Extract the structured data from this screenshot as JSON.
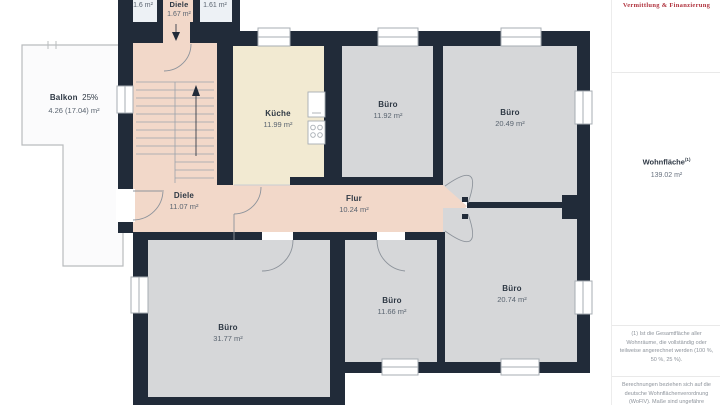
{
  "plan": {
    "rooms": {
      "balkon": {
        "name": "Balkon",
        "share": "25%",
        "area": "4.26 (17.04) m²"
      },
      "raum_ol": {
        "area": "1.6 m²"
      },
      "diele_top": {
        "name": "Diele",
        "area": "1.67 m²"
      },
      "raum_or": {
        "area": "1.61 m²"
      },
      "kueche": {
        "name": "Küche",
        "area": "11.99 m²"
      },
      "buero_nw": {
        "name": "Büro",
        "area": "11.92 m²"
      },
      "buero_ne": {
        "name": "Büro",
        "area": "20.49 m²"
      },
      "diele": {
        "name": "Diele",
        "area": "11.07 m²"
      },
      "flur": {
        "name": "Flur",
        "area": "10.24 m²"
      },
      "buero_sw": {
        "name": "Büro",
        "area": "31.77 m²"
      },
      "buero_sm": {
        "name": "Büro",
        "area": "11.66 m²"
      },
      "buero_se": {
        "name": "Büro",
        "area": "20.74 m²"
      }
    },
    "colors": {
      "wall": "#212b39",
      "office_fill": "#d6d7d9",
      "corridor_fill": "#f2d8c9",
      "kitchen_fill": "#f2ead2",
      "side_room_fill": "#edf1f5",
      "balcony_fill": "#fbfbfc",
      "logo_red": "#b0333e"
    }
  },
  "sidebar": {
    "logo_line": "Vermittlung & Finanzierung",
    "wohnflaeche": {
      "label": "Wohnfläche",
      "sup": "(1)",
      "value": "139.02 m²"
    },
    "note1": "(1) Ist die Gesamtfläche aller Wohnräume, die vollständig oder teilweise angerechnet werden (100 %, 50 %, 25 %).",
    "note2": "Berechnungen beziehen sich auf die deutsche Wohnflächenverordnung (WoFlV). Maße sind ungefähre Angaben"
  }
}
